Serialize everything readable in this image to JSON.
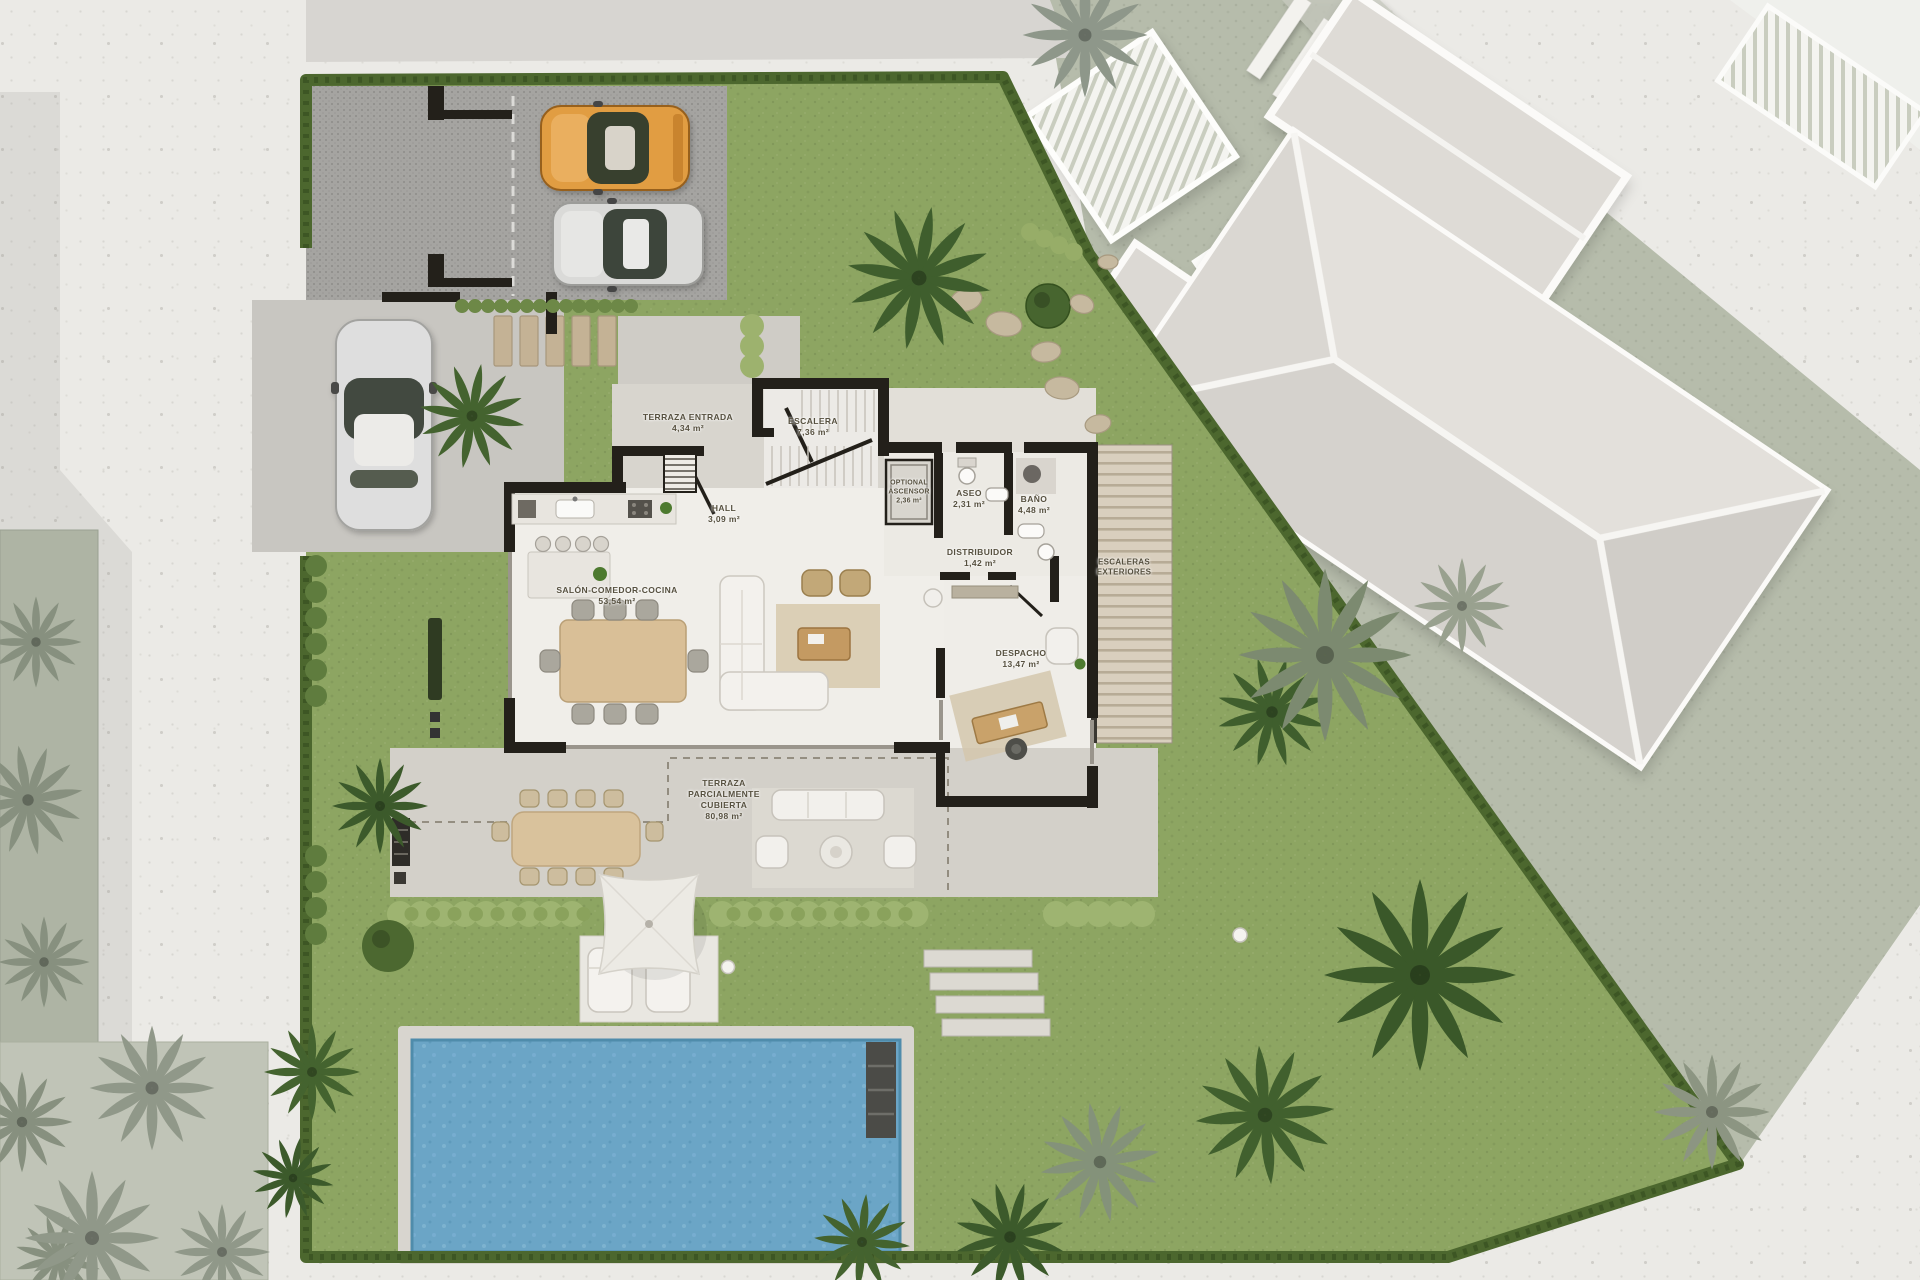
{
  "plan": {
    "title": "villa-ground-floor-site-plan",
    "rooms": [
      {
        "name": "TERRAZA ENTRADA",
        "area": "4,34 m²"
      },
      {
        "name": "ESCALERA",
        "area": "7,36 m²"
      },
      {
        "name": "HALL",
        "area": "3,09 m²"
      },
      {
        "name": "OPTIONAL ASCENSOR",
        "area": "2,36 m²"
      },
      {
        "name": "ASEO",
        "area": "2,31 m²"
      },
      {
        "name": "BAÑO",
        "area": "4,48 m²"
      },
      {
        "name": "DISTRIBUIDOR",
        "area": "1,42 m²"
      },
      {
        "name": "SALÓN-COMEDOR-COCINA",
        "area": "53,54 m²"
      },
      {
        "name": "DESPACHO",
        "area": "13,47 m²"
      },
      {
        "name": "ESCALERAS EXTERIORES",
        "area": ""
      },
      {
        "name": "TERRAZA PARCIALMENTE CUBIERTA",
        "area": "80,98 m²"
      }
    ],
    "colors": {
      "lawn": "#8da562",
      "muted_lawn": "#b6bcab",
      "hedge": "#4c672e",
      "pool_water": "#6ba5c6",
      "terrace": "#d3d0c9",
      "parking": "#a5a4a1",
      "house_wall": "#23201a",
      "orange_car": "#e19d43",
      "silver_car": "#dadad8",
      "background": "#ebeae6"
    }
  }
}
